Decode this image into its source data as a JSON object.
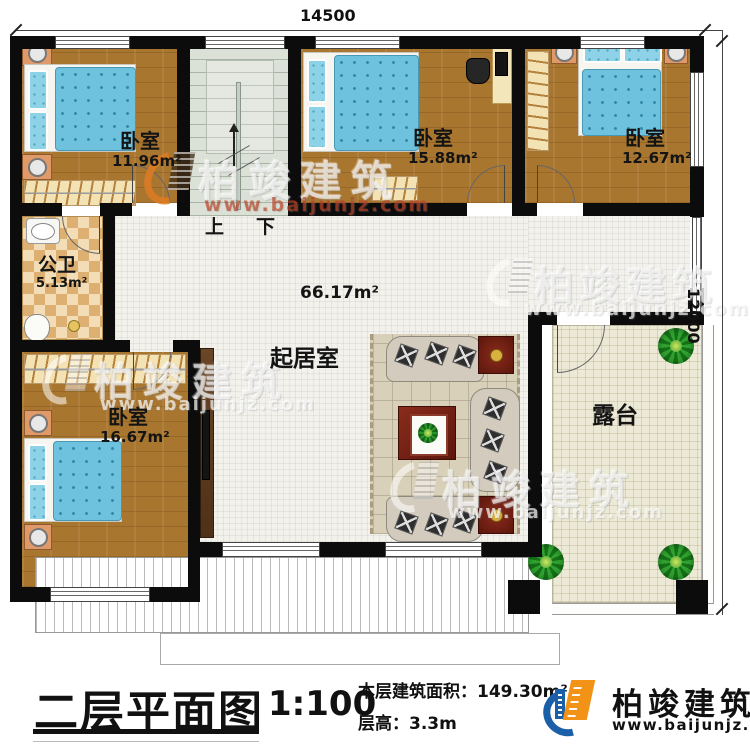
{
  "plan": {
    "dim_top": "14500",
    "dim_right": "12000",
    "stairs_up": "上",
    "stairs_down": "下",
    "bedroom1": {
      "name": "卧室",
      "area": "11.96m²"
    },
    "bedroom2": {
      "name": "卧室",
      "area": "15.88m²"
    },
    "bedroom3": {
      "name": "卧室",
      "area": "12.67m²"
    },
    "bathroom": {
      "name": "公卫",
      "area": "5.13m²"
    },
    "bedroom4": {
      "name": "卧室",
      "area": "16.67m²"
    },
    "living": {
      "name": "起居室",
      "area": "66.17m²"
    },
    "terrace": {
      "name": "露台"
    }
  },
  "watermark": {
    "brand": "柏竣建筑",
    "url": "www.baijunjz.com"
  },
  "title_block": {
    "title": "二层平面图",
    "scale": "1:100",
    "area_label": "本层建筑面积：",
    "area_value": "149.30m²",
    "height_label": "层高：",
    "height_value": "3.3m",
    "brand": "柏竣建筑",
    "brand_url": "www.baijunjz.com"
  },
  "colors": {
    "accent_blue": "#1a5fa8",
    "accent_orange": "#f29318",
    "wall": "#0c0c0c",
    "wood": "#a9762f"
  }
}
